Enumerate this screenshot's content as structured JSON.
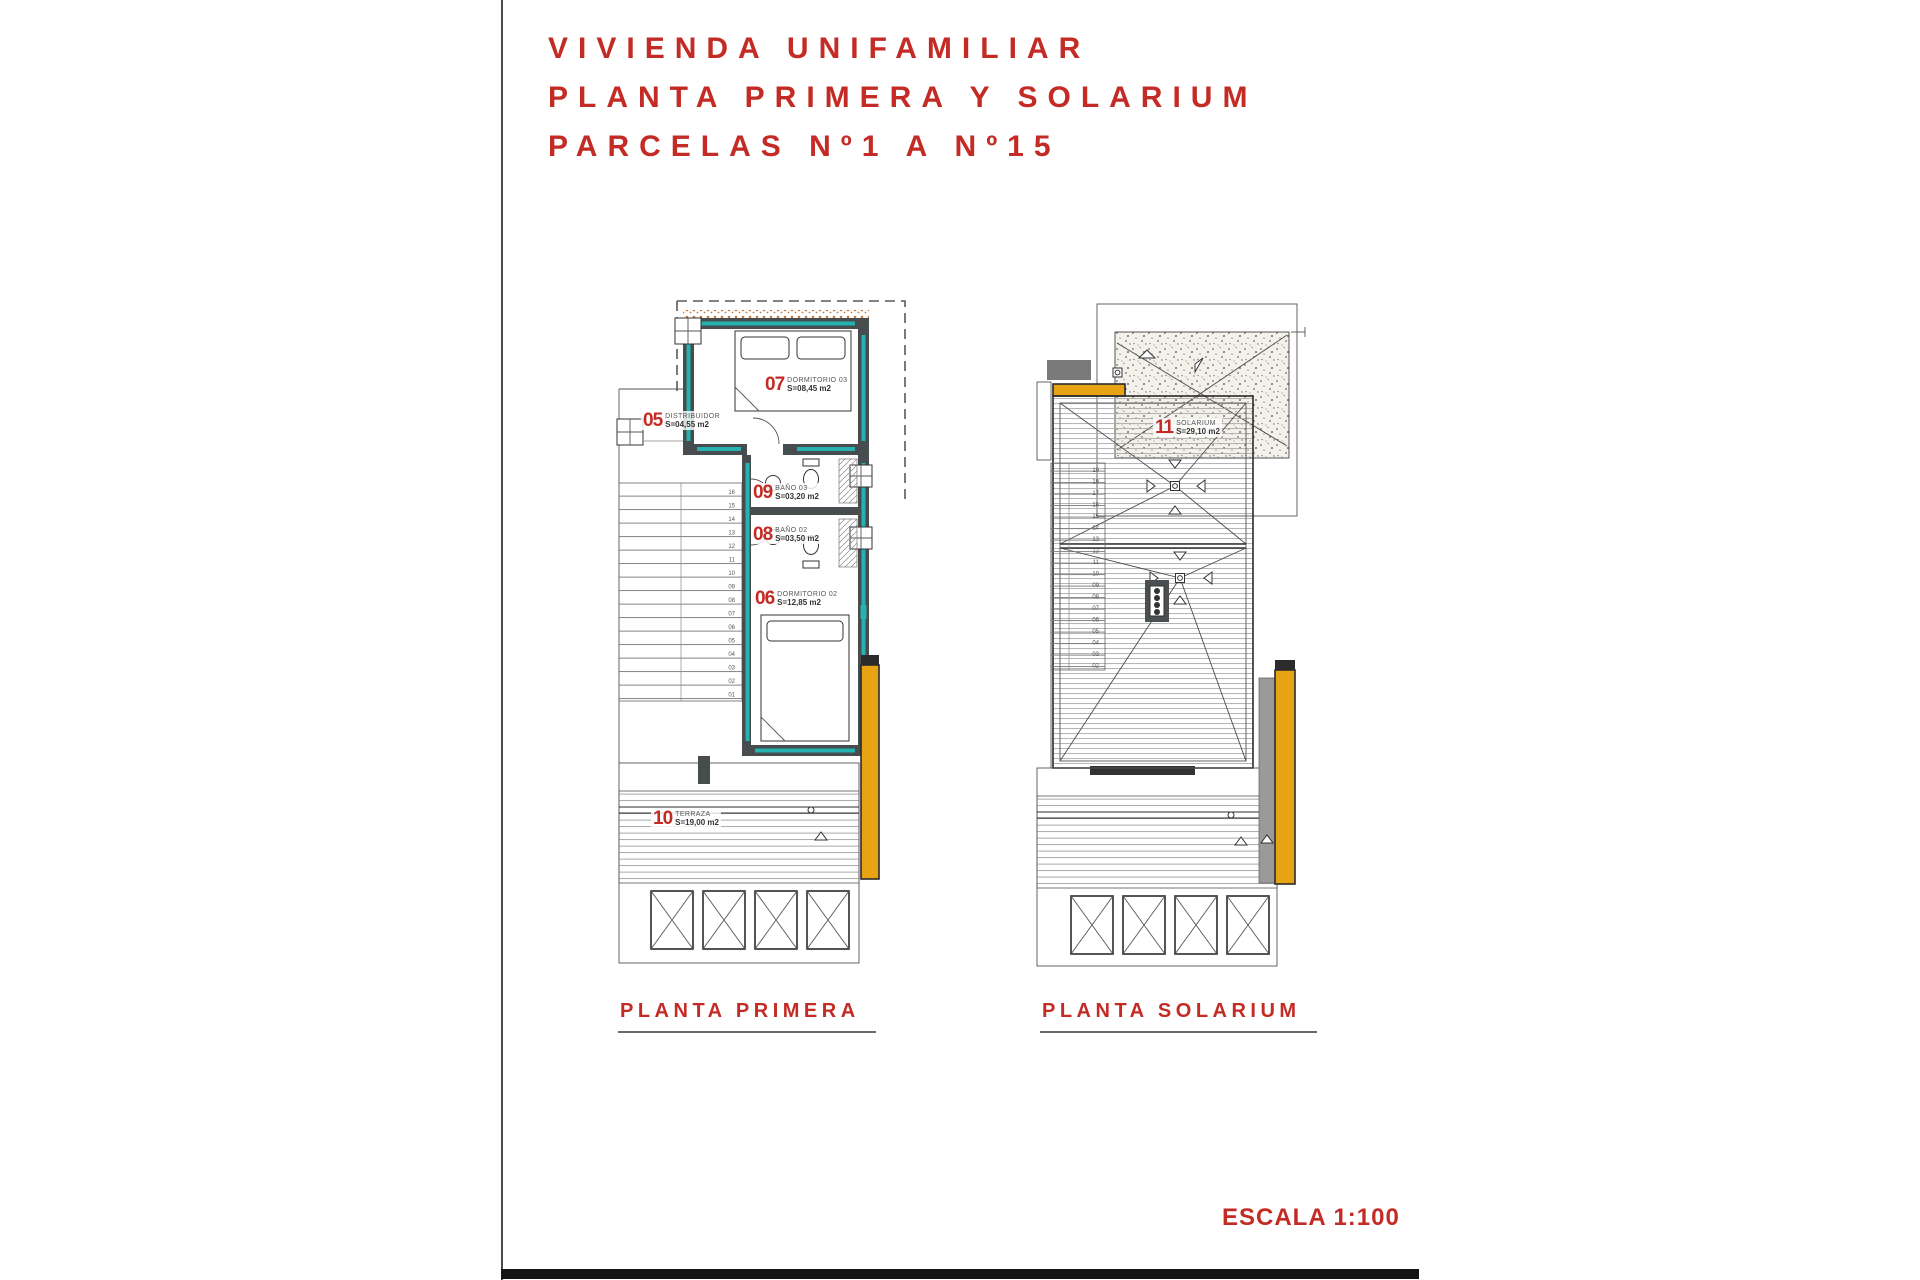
{
  "colors": {
    "red": "#c32b24",
    "teal": "#25b2b0",
    "orange": "#e7a312",
    "wall": "#474c4e"
  },
  "page": {
    "title_lines": [
      "VIVIENDA UNIFAMILIAR",
      "PLANTA PRIMERA Y SOLARIUM",
      "PARCELAS Nº1 A Nº15"
    ],
    "scale_label": "ESCALA 1:100"
  },
  "plans": {
    "primera": {
      "caption": "PLANTA PRIMERA",
      "rooms": {
        "r05": {
          "num": "05",
          "name": "DISTRIBUIDOR",
          "area": "S=04,55 m2"
        },
        "r07": {
          "num": "07",
          "name": "DORMITORIO 03",
          "area": "S=08,45 m2"
        },
        "r09": {
          "num": "09",
          "name": "BAÑO 03",
          "area": "S=03,20 m2"
        },
        "r08": {
          "num": "08",
          "name": "BAÑO 02",
          "area": "S=03,50 m2"
        },
        "r06": {
          "num": "06",
          "name": "DORMITORIO 02",
          "area": "S=12,85 m2"
        },
        "r10": {
          "num": "10",
          "name": "TERRAZA",
          "area": "S=19,00 m2"
        }
      },
      "stair_numbers": [
        "16",
        "15",
        "14",
        "13",
        "12",
        "11",
        "10",
        "09",
        "08",
        "07",
        "06",
        "05",
        "04",
        "03",
        "02",
        "01"
      ]
    },
    "solarium": {
      "caption": "PLANTA SOLARIUM",
      "rooms": {
        "r11": {
          "num": "11",
          "name": "SOLARIUM",
          "area": "S=29,10 m2"
        }
      },
      "stair_numbers": [
        "19",
        "18",
        "17",
        "16",
        "15",
        "14",
        "13",
        "12",
        "11",
        "10",
        "09",
        "08",
        "07",
        "06",
        "05",
        "04",
        "03",
        "02"
      ]
    }
  }
}
